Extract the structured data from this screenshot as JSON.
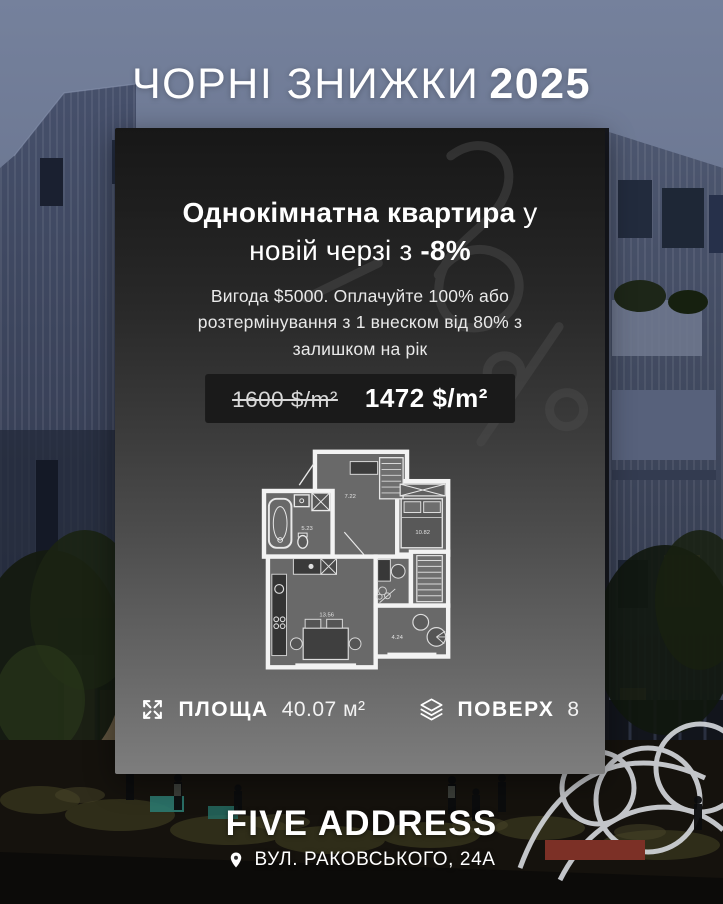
{
  "title": {
    "main": "ЧОРНІ ЗНИЖКИ",
    "year": "2025"
  },
  "card": {
    "heading": {
      "bold1": "Однокімнатна квартира",
      "regular1": " у",
      "regular2": "новій черзі з ",
      "bold2": "-8%"
    },
    "description": "Вигода $5000. Оплачуйте 100% або розтермінування з 1 внеском від 80% з залишком на рік",
    "pricing": {
      "old_price": "1600 $/m²",
      "new_price": "1472 $/m²"
    },
    "floorplan": {
      "rooms": [
        {
          "name": "hallway",
          "area": "7.22"
        },
        {
          "name": "bathroom",
          "area": "5.23"
        },
        {
          "name": "bedroom",
          "area": "10.82"
        },
        {
          "name": "kitchen-living",
          "area": "13.56"
        },
        {
          "name": "balcony",
          "area": "4.24"
        }
      ]
    },
    "stats": {
      "area_label": "ПЛОЩА",
      "area_value": "40.07 м²",
      "floor_label": "ПОВЕРХ",
      "floor_value": "8"
    }
  },
  "footer": {
    "brand": "FIVE ADDRESS",
    "address": "ВУЛ. РАКОВСЬКОГО, 24А"
  },
  "icons": {
    "area": "expand-icon",
    "floor": "layers-icon",
    "location": "location-pin-icon"
  },
  "colors": {
    "card_top": "#171717",
    "card_bottom": "#7d7d7d",
    "sky": "#6a7590",
    "lit_window": "#c9a86f",
    "sculpture": "#d6d9de",
    "planter_red": "#7c3026",
    "table_teal": "#2c7a70",
    "text_white": "#ffffff"
  }
}
